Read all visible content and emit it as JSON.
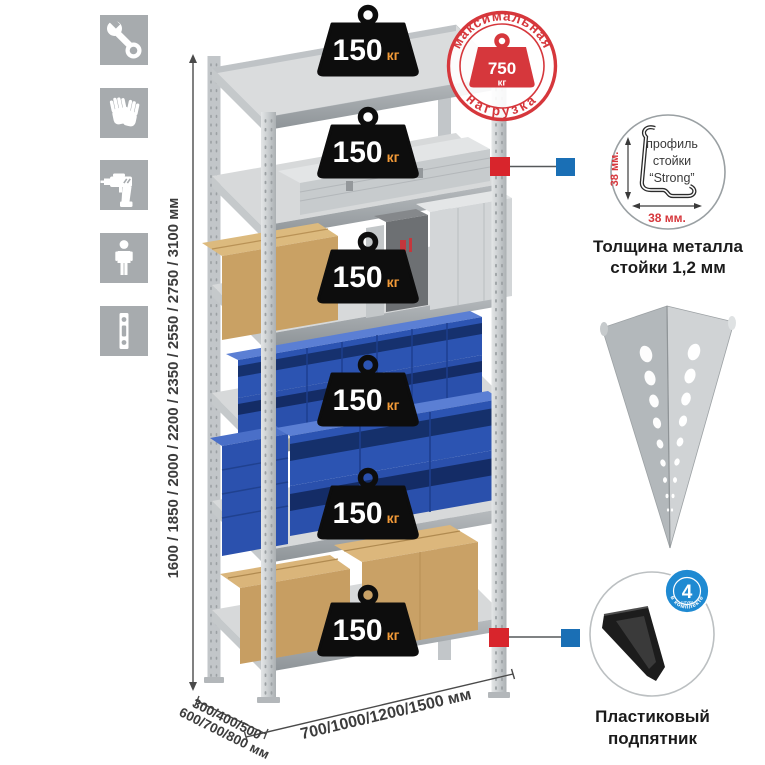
{
  "sidebar": {
    "icons": [
      {
        "name": "wrench-icon"
      },
      {
        "name": "gloves-icon"
      },
      {
        "name": "drill-icon"
      },
      {
        "name": "person-icon"
      },
      {
        "name": "post-icon"
      }
    ]
  },
  "dimensions": {
    "height": "1600 / 1850 / 2000 / 2200 / 2350 / 2550 / 2750 / 3100 мм",
    "depth_line1": "300/400/500",
    "depth_line2": "600/700/800 мм",
    "width": "700/1000/1200/1500 мм"
  },
  "shelf_weight": {
    "value": "150",
    "unit": "кг"
  },
  "max_load_stamp": {
    "arc_top": "максимальная",
    "arc_bottom": "нагрузка",
    "value": "750",
    "unit": "кг"
  },
  "profile_callout": {
    "label_line1": "профиль",
    "label_line2": "стойки",
    "label_line3": "“Strong”",
    "dim_vertical": "38 мм.",
    "dim_horizontal": "38 мм.",
    "caption_line1": "Толщина металла",
    "caption_line2": "стойки 1,2 мм"
  },
  "foot_callout": {
    "badge_value": "4",
    "badge_sub": "штуки",
    "badge_arc": "в комплекте",
    "caption_line1": "Пластиковый",
    "caption_line2": "подпятник"
  },
  "colors": {
    "stamp_red": "#d6373c",
    "marker_red": "#d8252c",
    "marker_blue": "#1a6fb5",
    "badge_blue": "#1f8ad2",
    "bin_blue": "#2b52ae",
    "weight_black": "#0d0d0d",
    "weight_unit_orange": "#f29a38",
    "icon_gray": "#a7abae"
  }
}
